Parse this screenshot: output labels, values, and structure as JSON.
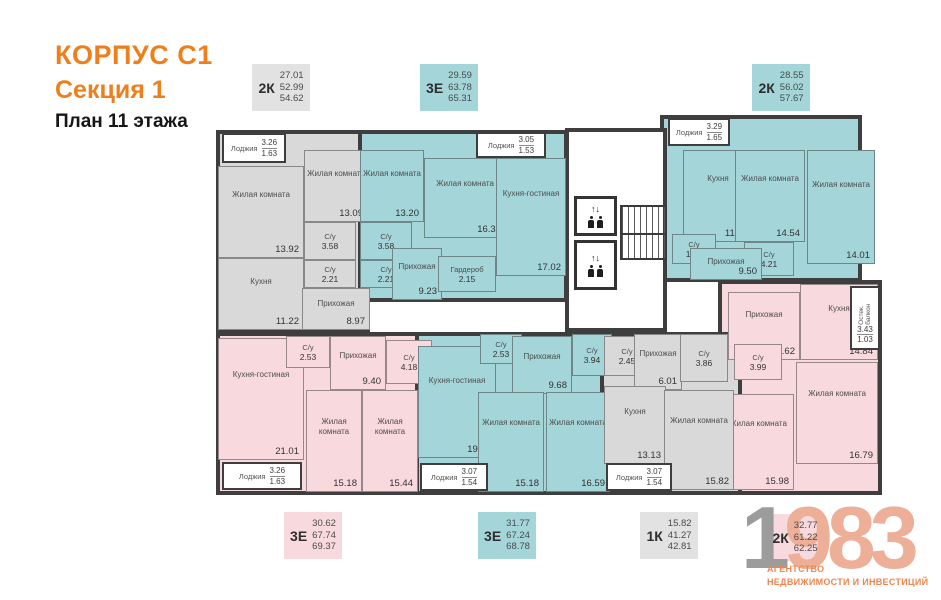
{
  "header": {
    "building": "КОРПУС С1",
    "section": "Секция 1",
    "plan": "План 11 этажа"
  },
  "colors": {
    "orange": "#ef7f1d",
    "gray": "#d9d9d9",
    "teal": "#a3d5d9",
    "pink": "#f8d9de",
    "legend_gray": "#e2e2e2",
    "wall": "#3e3e3e",
    "logo_gray": "#9c9c9c",
    "logo_salmon": "#edaf97",
    "tagline_orange": "#ee8650"
  },
  "legends": [
    {
      "type": "2К",
      "values": [
        "27.01",
        "52.99",
        "54.62"
      ],
      "color": "legend_gray",
      "x": 252,
      "y": 64
    },
    {
      "type": "3Е",
      "values": [
        "29.59",
        "63.78",
        "65.31"
      ],
      "color": "teal",
      "x": 420,
      "y": 64
    },
    {
      "type": "2К",
      "values": [
        "28.55",
        "56.02",
        "57.67"
      ],
      "color": "teal",
      "x": 752,
      "y": 64
    },
    {
      "type": "3Е",
      "values": [
        "30.62",
        "67.74",
        "69.37"
      ],
      "color": "pink",
      "x": 284,
      "y": 512
    },
    {
      "type": "3Е",
      "values": [
        "31.77",
        "67.24",
        "68.78"
      ],
      "color": "teal",
      "x": 478,
      "y": 512
    },
    {
      "type": "1К",
      "values": [
        "15.82",
        "41.27",
        "42.81"
      ],
      "color": "legend_gray",
      "x": 640,
      "y": 512
    },
    {
      "type": "2К",
      "values": [
        "32.77",
        "61.22",
        "62.25"
      ],
      "color": "pink",
      "x": 766,
      "y": 514
    }
  ],
  "apartments": [
    {
      "id": "2k-top-left",
      "fill": "gray",
      "outlines": [
        [
          216,
          130,
          154,
          202
        ]
      ],
      "rooms": [
        {
          "kind": "loggia",
          "name": "Лоджия",
          "v1": "3.26",
          "v2": "1.63",
          "r": [
            222,
            133,
            64,
            30
          ]
        },
        {
          "name": "Жилая комната",
          "area": "13.92",
          "r": [
            218,
            166,
            86,
            92
          ]
        },
        {
          "name": "Кухня",
          "area": "11.22",
          "r": [
            218,
            258,
            86,
            72
          ]
        },
        {
          "name": "Жилая комната",
          "area": "13.09",
          "r": [
            304,
            150,
            64,
            72
          ]
        },
        {
          "kind": "small",
          "name": "С/у",
          "area": "3.58",
          "r": [
            304,
            222,
            52,
            38
          ]
        },
        {
          "kind": "small",
          "name": "С/у",
          "area": "2.21",
          "r": [
            304,
            260,
            52,
            28
          ]
        },
        {
          "name": "Прихожая",
          "area": "8.97",
          "r": [
            302,
            288,
            68,
            42
          ]
        }
      ]
    },
    {
      "id": "3e-top",
      "fill": "teal",
      "outlines": [
        [
          358,
          130,
          210,
          172
        ]
      ],
      "rooms": [
        {
          "kind": "loggia",
          "name": "Лоджия",
          "v1": "3.05",
          "v2": "1.53",
          "r": [
            476,
            132,
            70,
            26
          ]
        },
        {
          "name": "Жилая комната",
          "area": "13.20",
          "r": [
            360,
            150,
            64,
            72
          ]
        },
        {
          "kind": "small",
          "name": "С/у",
          "area": "3.58",
          "r": [
            360,
            222,
            52,
            38
          ]
        },
        {
          "kind": "small",
          "name": "С/у",
          "area": "2.21",
          "r": [
            360,
            260,
            52,
            28
          ]
        },
        {
          "name": "Жилая комната",
          "area": "16.39",
          "r": [
            424,
            158,
            82,
            80
          ]
        },
        {
          "name": "Кухня-гостиная",
          "area": "17.02",
          "r": [
            496,
            158,
            70,
            118
          ]
        },
        {
          "name": "Прихожая",
          "area": "9.23",
          "r": [
            392,
            248,
            50,
            52
          ]
        },
        {
          "kind": "small",
          "name": "Гардероб",
          "area": "2.15",
          "r": [
            438,
            256,
            58,
            36
          ]
        }
      ]
    },
    {
      "id": "2k-top-right",
      "fill": "teal",
      "outlines": [
        [
          660,
          115,
          202,
          167
        ]
      ],
      "rooms": [
        {
          "kind": "loggia",
          "name": "Лоджия",
          "v1": "3.29",
          "v2": "1.65",
          "r": [
            668,
            118,
            62,
            28
          ]
        },
        {
          "name": "Кухня",
          "area": "11.87",
          "r": [
            683,
            150,
            70,
            92
          ]
        },
        {
          "name": "Жилая комната",
          "area": "14.54",
          "r": [
            735,
            150,
            70,
            92
          ]
        },
        {
          "name": "Жилая комната",
          "area": "14.01",
          "r": [
            807,
            150,
            68,
            114
          ]
        },
        {
          "kind": "small",
          "name": "С/у",
          "area": "1.89",
          "r": [
            672,
            234,
            44,
            30
          ]
        },
        {
          "kind": "small",
          "name": "С/у",
          "area": "4.21",
          "r": [
            744,
            242,
            50,
            34
          ]
        },
        {
          "name": "Прихожая",
          "area": "9.50",
          "r": [
            690,
            248,
            72,
            32
          ]
        }
      ]
    },
    {
      "id": "2k-right",
      "fill": "pink",
      "outlines": [
        [
          718,
          280,
          164,
          215
        ]
      ],
      "rooms": [
        {
          "name": "Прихожая",
          "area": "9.62",
          "r": [
            728,
            292,
            72,
            68
          ]
        },
        {
          "name": "Кухня",
          "area": "14.84",
          "r": [
            800,
            284,
            78,
            76
          ]
        },
        {
          "kind": "small",
          "name": "С/у",
          "area": "3.99",
          "r": [
            734,
            344,
            48,
            36
          ]
        },
        {
          "name": "Жилая комната",
          "area": "16.79",
          "r": [
            796,
            362,
            82,
            102
          ]
        },
        {
          "name": "Жилая комната",
          "area": "15.98",
          "r": [
            722,
            394,
            72,
            96
          ]
        },
        {
          "kind": "vbalcony",
          "name": "Остек. балкон",
          "v1": "3.43",
          "v2": "1.03",
          "r": [
            850,
            286,
            30,
            64
          ]
        }
      ]
    },
    {
      "id": "3e-bottom-left",
      "fill": "pink",
      "outlines": [
        [
          216,
          332,
          204,
          163
        ]
      ],
      "rooms": [
        {
          "name": "Кухня-гостиная",
          "area": "21.01",
          "r": [
            218,
            338,
            86,
            122
          ]
        },
        {
          "kind": "small",
          "name": "С/у",
          "area": "2.53",
          "r": [
            286,
            336,
            44,
            32
          ]
        },
        {
          "name": "Прихожая",
          "area": "9.40",
          "r": [
            330,
            336,
            56,
            54
          ]
        },
        {
          "kind": "small",
          "name": "С/у",
          "area": "4.18",
          "r": [
            386,
            340,
            46,
            44
          ]
        },
        {
          "name": "Жилая комната",
          "area": "15.18",
          "r": [
            306,
            390,
            56,
            102
          ]
        },
        {
          "name": "Жилая комната",
          "area": "15.44",
          "r": [
            362,
            390,
            56,
            102
          ]
        },
        {
          "kind": "loggia",
          "name": "Лоджия",
          "v1": "3.26",
          "v2": "1.63",
          "r": [
            222,
            462,
            80,
            28
          ]
        }
      ]
    },
    {
      "id": "3e-bottom-mid",
      "fill": "teal",
      "outlines": [
        [
          415,
          332,
          198,
          163
        ]
      ],
      "rooms": [
        {
          "name": "Кухня-гостиная",
          "area": "19.32",
          "r": [
            418,
            346,
            78,
            112
          ]
        },
        {
          "kind": "small",
          "name": "С/у",
          "area": "2.53",
          "r": [
            480,
            334,
            42,
            30
          ]
        },
        {
          "name": "Прихожая",
          "area": "9.68",
          "r": [
            512,
            336,
            60,
            58
          ]
        },
        {
          "kind": "small",
          "name": "С/у",
          "area": "3.94",
          "r": [
            572,
            334,
            40,
            42
          ]
        },
        {
          "name": "Жилая комната",
          "area": "15.18",
          "r": [
            478,
            392,
            66,
            100
          ]
        },
        {
          "name": "Жилая комната",
          "area": "16.59",
          "r": [
            546,
            392,
            64,
            100
          ]
        },
        {
          "kind": "loggia",
          "name": "Лоджия",
          "v1": "3.07",
          "v2": "1.54",
          "r": [
            420,
            463,
            68,
            28
          ]
        }
      ]
    },
    {
      "id": "1k-bottom",
      "fill": "gray",
      "outlines": [
        [
          600,
          332,
          142,
          163
        ]
      ],
      "rooms": [
        {
          "kind": "small",
          "name": "С/у",
          "area": "2.45",
          "r": [
            604,
            336,
            46,
            40
          ]
        },
        {
          "name": "Прихожая",
          "area": "6.01",
          "r": [
            634,
            334,
            48,
            56
          ]
        },
        {
          "kind": "small",
          "name": "С/у",
          "area": "3.86",
          "r": [
            680,
            334,
            48,
            48
          ]
        },
        {
          "name": "Кухня",
          "area": "13.13",
          "r": [
            604,
            386,
            62,
            78
          ]
        },
        {
          "name": "Жилая комната",
          "area": "15.82",
          "r": [
            664,
            390,
            70,
            100
          ]
        },
        {
          "kind": "loggia",
          "name": "Лоджия",
          "v1": "3.07",
          "v2": "1.54",
          "r": [
            606,
            463,
            66,
            28
          ]
        }
      ]
    }
  ],
  "core": {
    "arrows": "↑↓"
  },
  "logo": {
    "digit_gray": "1",
    "digits_salmon": "983",
    "tagline1": "АГЕНТСТВО",
    "tagline2": "НЕДВИЖИМОСТИ И ИНВЕСТИЦИЙ"
  }
}
